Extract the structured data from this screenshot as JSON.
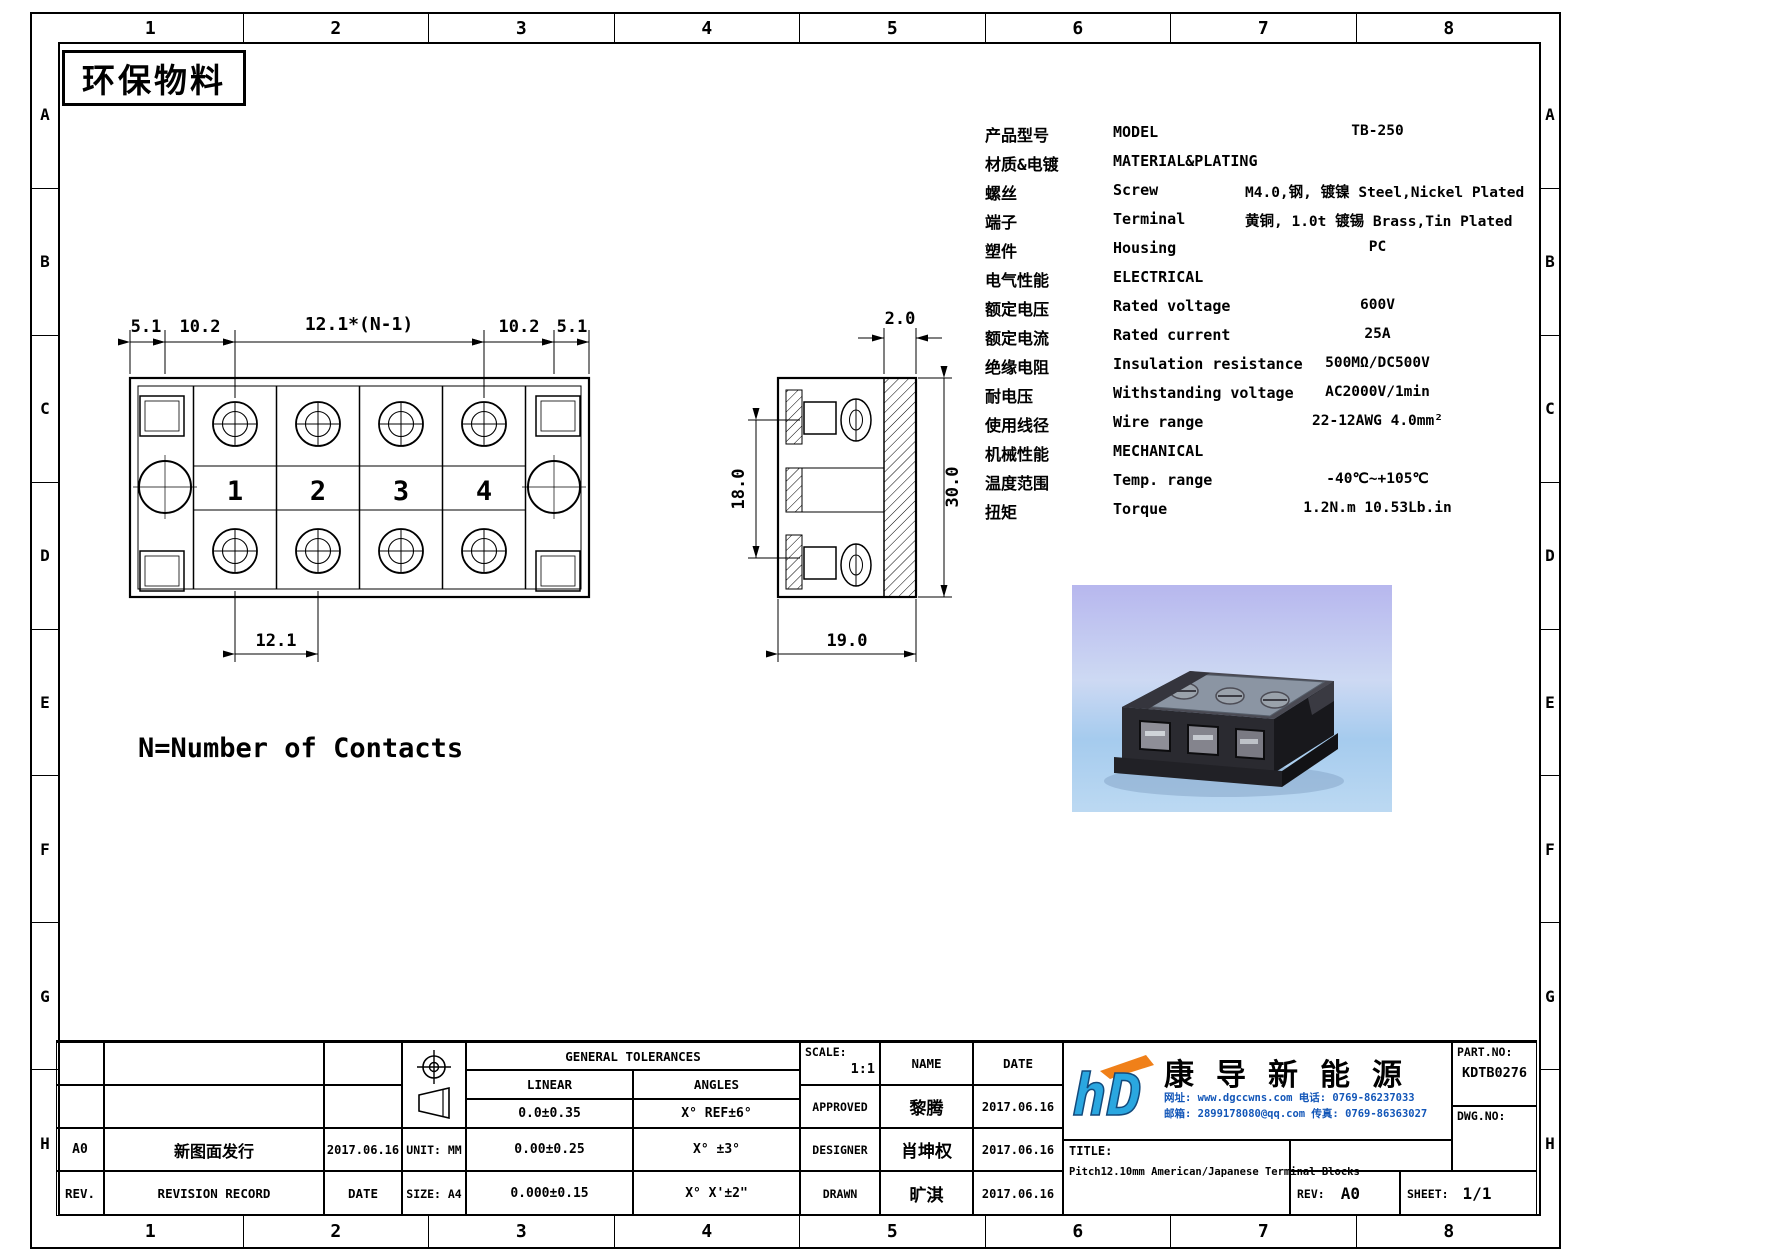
{
  "sheet": {
    "stamp": "环保物料",
    "grid_columns": [
      "1",
      "2",
      "3",
      "4",
      "5",
      "6",
      "7",
      "8"
    ],
    "grid_rows": [
      "A",
      "B",
      "C",
      "D",
      "E",
      "F",
      "G",
      "H"
    ]
  },
  "specs": {
    "rows": [
      {
        "cn": "产品型号",
        "en": "MODEL",
        "val": "TB-250"
      },
      {
        "cn": "材质&电镀",
        "en": "MATERIAL&PLATING",
        "val": ""
      },
      {
        "cn": "螺丝",
        "en": "Screw",
        "val": "M4.0,钢, 镀镍 Steel,Nickel Plated"
      },
      {
        "cn": "端子",
        "en": "Terminal",
        "val": "黄铜, 1.0t 镀锡 Brass,Tin Plated"
      },
      {
        "cn": "塑件",
        "en": "Housing",
        "val": "PC"
      },
      {
        "cn": "电气性能",
        "en": "ELECTRICAL",
        "val": ""
      },
      {
        "cn": "额定电压",
        "en": "Rated voltage",
        "val": "600V"
      },
      {
        "cn": "额定电流",
        "en": "Rated current",
        "val": "25A"
      },
      {
        "cn": "绝缘电阻",
        "en": "Insulation resistance",
        "val": "500MΩ/DC500V"
      },
      {
        "cn": "耐电压",
        "en": "Withstanding voltage",
        "val": "AC2000V/1min"
      },
      {
        "cn": "使用线径",
        "en": "Wire range",
        "val": "22-12AWG 4.0mm²"
      },
      {
        "cn": "机械性能",
        "en": "MECHANICAL",
        "val": ""
      },
      {
        "cn": "温度范围",
        "en": "Temp. range",
        "val": "-40℃~+105℃"
      },
      {
        "cn": "扭矩",
        "en": "Torque",
        "val": "1.2N.m  10.53Lb.in"
      }
    ]
  },
  "drawing": {
    "note": "N=Number of Contacts",
    "top_view": {
      "dim_left_a": "5.1",
      "dim_left_b": "10.2",
      "dim_center": "12.1*(N-1)",
      "dim_right_b": "10.2",
      "dim_right_a": "5.1",
      "dim_pitch": "12.1",
      "numbers": [
        "1",
        "2",
        "3",
        "4"
      ]
    },
    "section_view": {
      "dim_thickness": "2.0",
      "dim_inner_height": "18.0",
      "dim_height": "30.0",
      "dim_depth": "19.0"
    }
  },
  "title_block": {
    "revision": {
      "rev_value": "A0",
      "record_value": "新图面发行",
      "date_value": "2017.06.16",
      "rev_label": "REV.",
      "record_label": "REVISION RECORD",
      "date_label": "DATE"
    },
    "unit": "UNIT: MM",
    "size": "SIZE: A4",
    "tolerances": {
      "header": "GENERAL TOLERANCES",
      "linear_label": "LINEAR",
      "angles_label": "ANGLES",
      "linear_1": "0.0±0.35",
      "linear_2": "0.00±0.25",
      "linear_3": "0.000±0.15",
      "angles_1": "X° REF±6°",
      "angles_2": "X° ±3°",
      "angles_3": "X° X'±2\""
    },
    "scale_label": "SCALE:",
    "scale_value": "1:1",
    "name_label": "NAME",
    "date_label": "DATE",
    "approved_label": "APPROVED",
    "approved_name": "黎腾",
    "approved_date": "2017.06.16",
    "designer_label": "DESIGNER",
    "designer_name": "肖坤权",
    "designer_date": "2017.06.16",
    "drawn_label": "DRAWN",
    "drawn_name": "旷淇",
    "drawn_date": "2017.06.16",
    "company": {
      "logo_text": "hD",
      "name": "康导新能源",
      "contact_line1": "网址: www.dgccwns.com   电话: 0769-86237033",
      "contact_line2": "邮箱: 2899178080@qq.com 传真: 0769-86363027"
    },
    "title_label": "TITLE:",
    "title": "Pitch12.10mm American/Japanese Terminal Blocks",
    "part_no_label": "PART.NO:",
    "part_no": "KDTB0276",
    "dwg_no_label": "DWG.NO:",
    "rev_label": "REV:",
    "rev": "A0",
    "sheet_label": "SHEET:",
    "sheet": "1/1"
  }
}
